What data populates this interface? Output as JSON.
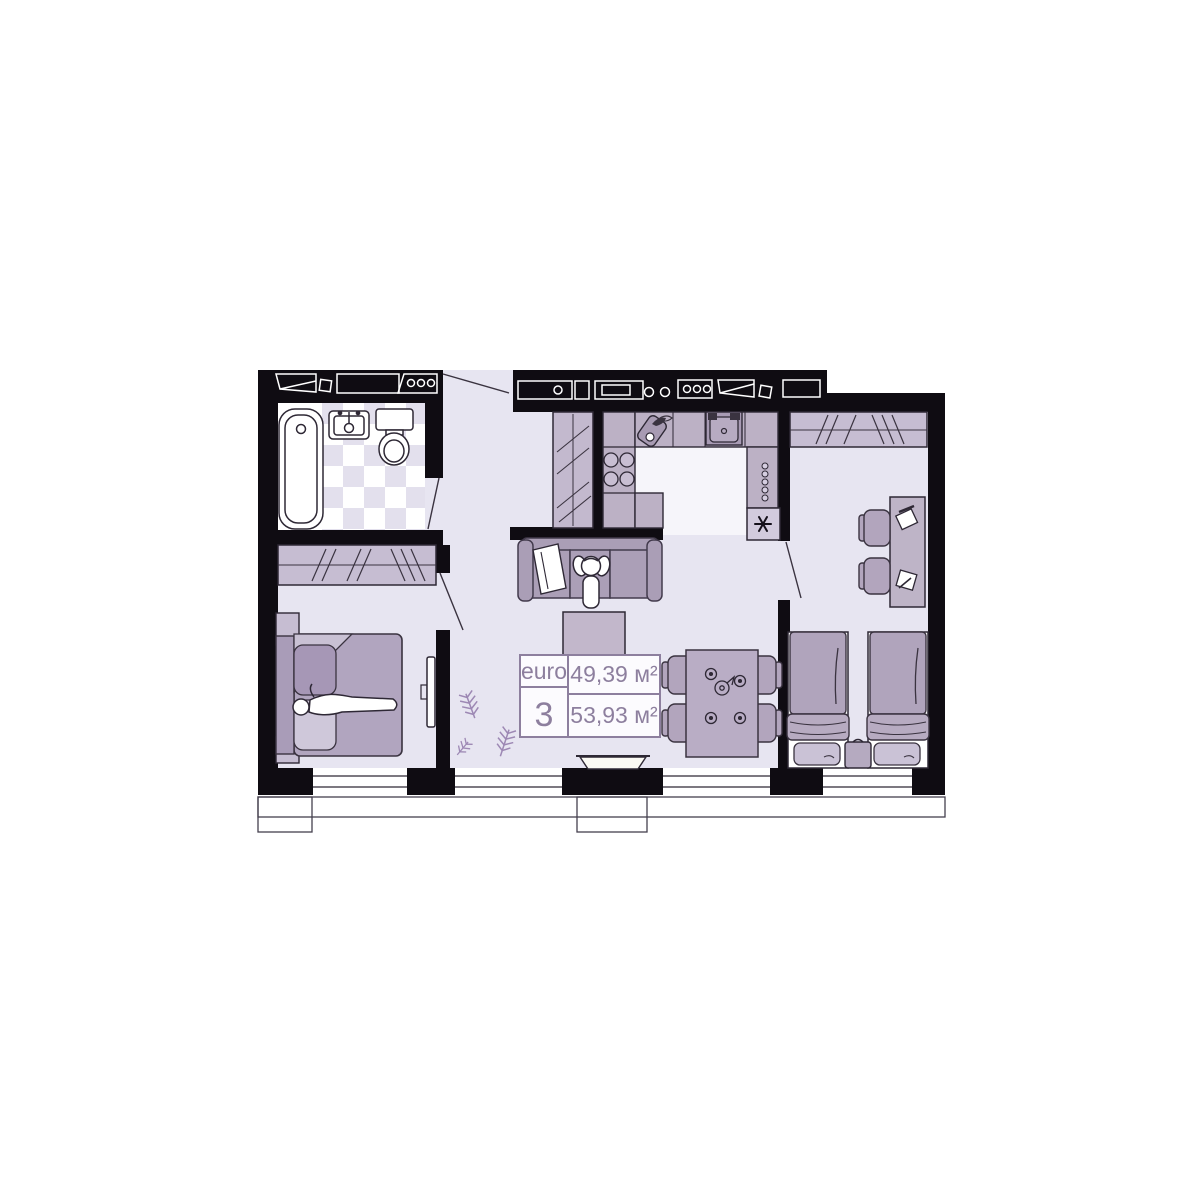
{
  "floor_plan": {
    "unit_type_label": "euro",
    "unit_type_number": "3",
    "living_area": "49,39 м²",
    "total_area": "53,93 м²"
  },
  "colors": {
    "wall": "#0f0c12",
    "floor": "#e7e5f1",
    "floor_highlight": "#f6f5fa",
    "checker_tile": "#e3e0ed",
    "furniture_mid": "#ab9fb8",
    "furniture_light": "#c6bdd2",
    "counter": "#bcb1c5",
    "label_accent": "#8d7f9e",
    "plant": "#9d88b4",
    "background": "#ffffff"
  }
}
